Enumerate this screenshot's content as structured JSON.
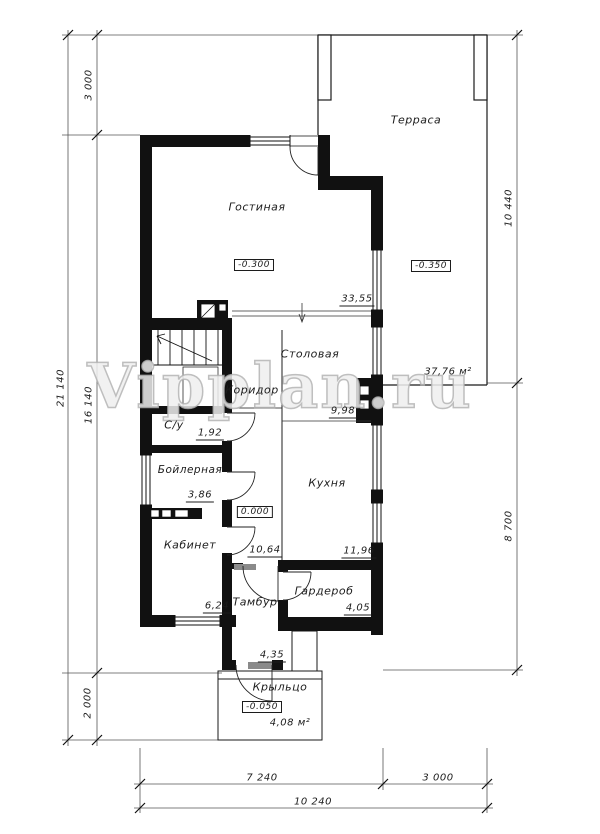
{
  "watermark": "Vipplan.ru",
  "rooms": {
    "terrace": {
      "name": "Терраса",
      "area": "37,76 м²",
      "level": "-0.350"
    },
    "living": {
      "name": "Гостиная",
      "area": "33,55",
      "level": "-0.300"
    },
    "dining": {
      "name": "Столовая",
      "area": "9,98"
    },
    "corridor": {
      "name": "Коридор",
      "area": "10,64"
    },
    "wc": {
      "name": "С/у",
      "area": "1,92"
    },
    "boiler": {
      "name": "Бойлерная",
      "area": "3,86"
    },
    "office": {
      "name": "Кабинет",
      "area": "6,24"
    },
    "kitchen": {
      "name": "Кухня",
      "area": "11,96"
    },
    "tambour": {
      "name": "Тамбур",
      "area": "4,35"
    },
    "wardrobe": {
      "name": "Гардероб",
      "area": "4,05"
    },
    "porch": {
      "name": "Крыльцо",
      "area": "4,08 м²",
      "level": "-0.050"
    }
  },
  "levels": {
    "entry": "0.000"
  },
  "dimensions": {
    "left_total": "21 140",
    "left_top": "3 000",
    "left_middle": "16 140",
    "left_bottom": "2 000",
    "right_top": "10 440",
    "right_bottom": "8 700",
    "bottom_left": "7 240",
    "bottom_right": "3 000",
    "bottom_total": "10 240"
  }
}
